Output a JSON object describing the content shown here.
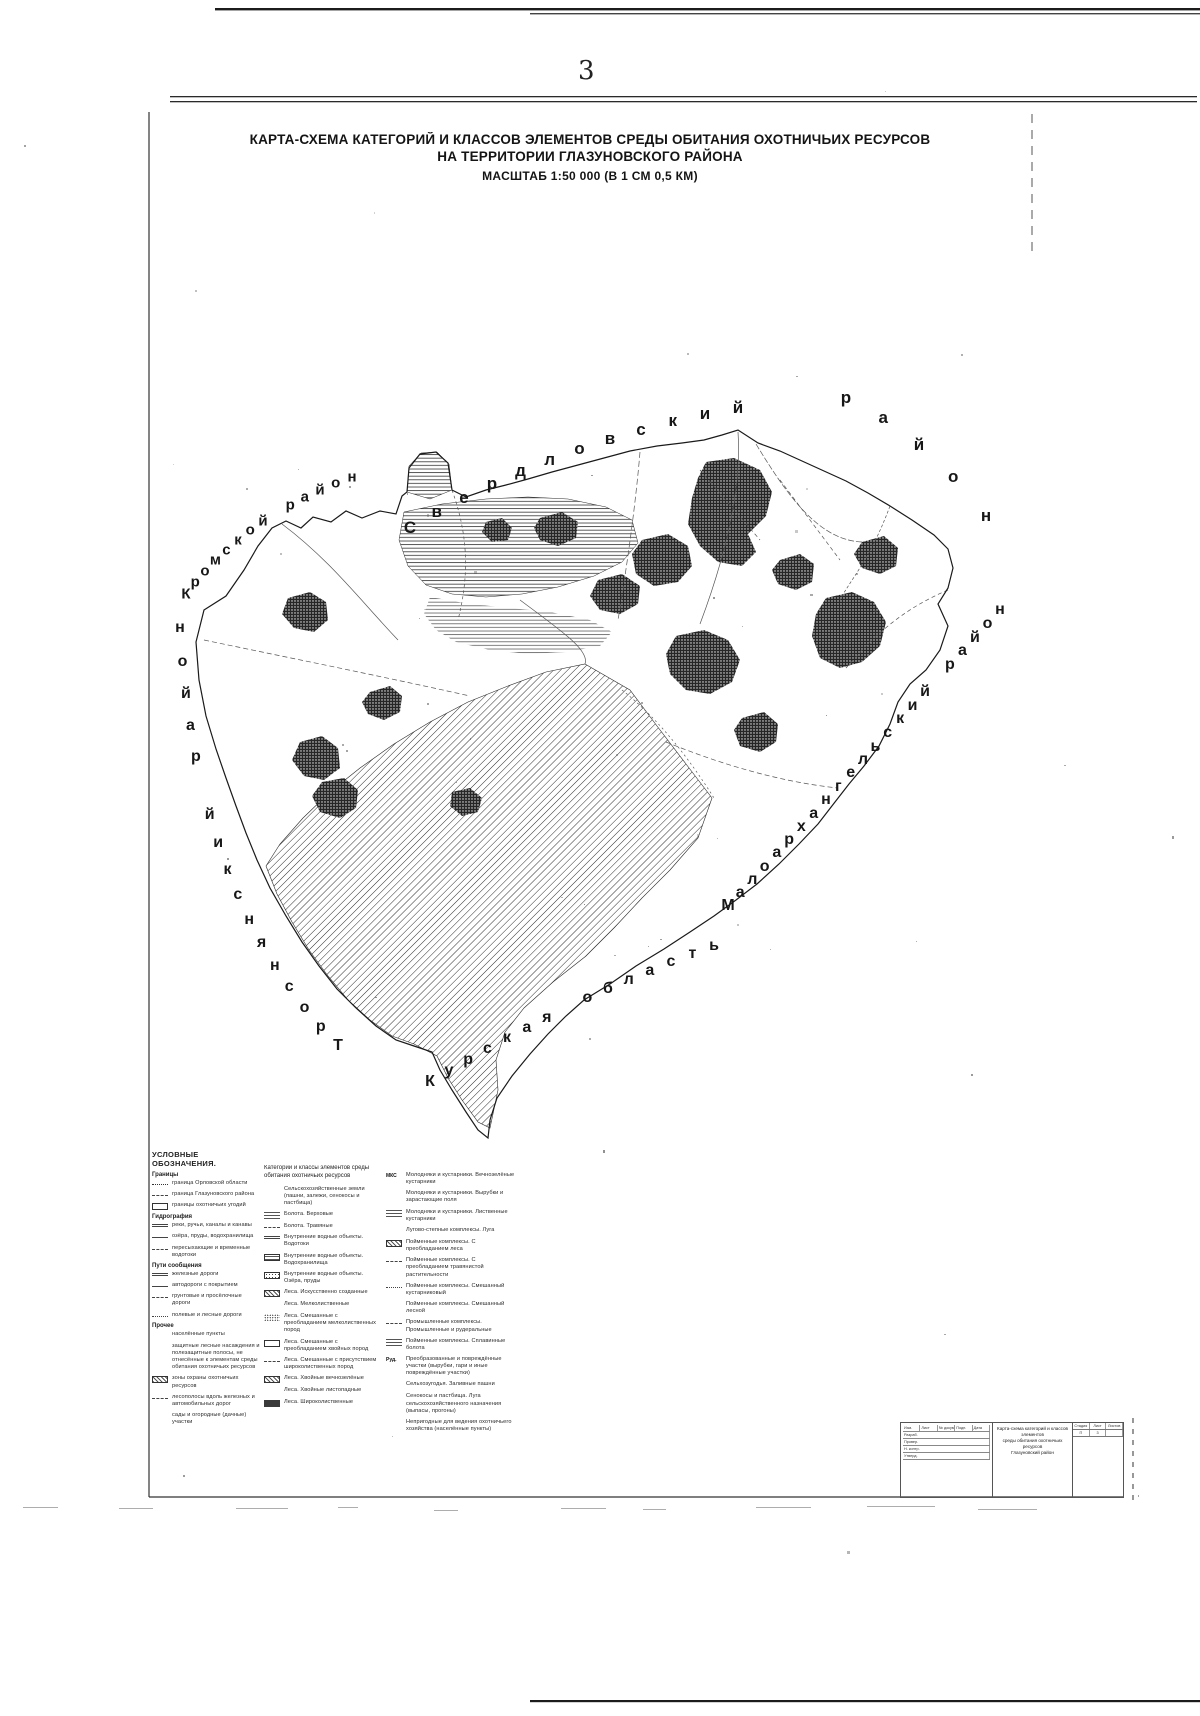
{
  "page": {
    "number": "3"
  },
  "title": {
    "line1": "КАРТА-СХЕМА КАТЕГОРИЙ И КЛАССОВ ЭЛЕМЕНТОВ СРЕДЫ ОБИТАНИЯ ОХОТНИЧЬИХ РЕСУРСОВ",
    "line2": "НА ТЕРРИТОРИИ ГЛАЗУНОВСКОГО РАЙОНА",
    "line3": "МАСШТАБ 1:50 000 (В 1 СМ 0,5 КМ)"
  },
  "map": {
    "neighbors": {
      "kromskoy": "Кромской район",
      "sverdlovsky": "Свердловский",
      "sverdlovsky_rayon": "район",
      "trosnyansky": "Троснянский район",
      "maloarkhangelsky": "Малоархангельский район",
      "kurskaya": "Курская область"
    }
  },
  "legend": {
    "header": "УСЛОВНЫЕ ОБОЗНАЧЕНИЯ.",
    "col1": [
      {
        "section": "Границы"
      },
      {
        "sym": "dashdot",
        "label": "граница Орловской области"
      },
      {
        "sym": "dash",
        "label": "граница Глазуновского района"
      },
      {
        "sym": "rect",
        "label": "границы охотничьих угодий"
      },
      {
        "section": "Гидрография"
      },
      {
        "sym": "dbl",
        "label": "реки, ручьи, каналы и канавы"
      },
      {
        "sym": "line",
        "label": "озёра, пруды, водохранилища"
      },
      {
        "sym": "dash",
        "label": "пересыхающие и временные водотоки"
      },
      {
        "section": "Пути сообщения"
      },
      {
        "sym": "dbl",
        "label": "железные дороги"
      },
      {
        "sym": "line",
        "label": "автодороги с покрытием"
      },
      {
        "sym": "dash",
        "label": "грунтовые и просёлочные дороги"
      },
      {
        "sym": "dot",
        "label": "полевые и лесные дороги"
      },
      {
        "section": "Прочее"
      },
      {
        "sym": "blank",
        "label": "населённые пункты"
      },
      {
        "sym": "blank",
        "label": "защитные лесные насаждения и полезащитные полосы, не отнесённые к элементам среды обитания охотничьих ресурсов"
      },
      {
        "sym": "hatch",
        "label": "зоны охраны охотничьих ресурсов"
      },
      {
        "sym": "dash",
        "label": "лесополосы вдоль железных и автомобильных дорог"
      },
      {
        "sym": "blank",
        "label": "сады и огородные (дачные) участки"
      }
    ],
    "col2_header": "Категории и классы элементов среды обитания охотничьих ресурсов",
    "col2": [
      {
        "sym": "blank",
        "label": "Сельскохозяйственные земли (пашни, залежи, сенокосы и пастбища)"
      },
      {
        "sym": "hlines2",
        "label": "Болота. Верховые"
      },
      {
        "sym": "dash",
        "label": "Болота. Травяные"
      },
      {
        "sym": "dbl",
        "label": "Внутренние водные объекты. Водотоки"
      },
      {
        "sym": "hlines",
        "label": "Внутренние водные объекты. Водохранилища"
      },
      {
        "sym": "dots",
        "label": "Внутренние водные объекты. Озёра, пруды"
      },
      {
        "sym": "hatch",
        "label": "Леса. Искусственно созданные"
      },
      {
        "sym": "blank",
        "label": "Леса. Мелколиственные"
      },
      {
        "sym": "specks",
        "label": "Леса. Смешанные с преобладанием мелколиственных пород"
      },
      {
        "sym": "rect",
        "label": "Леса. Смешанные с преобладанием хвойных пород"
      },
      {
        "sym": "dash",
        "label": "Леса. Смешанные с присутствием широколиственных пород"
      },
      {
        "sym": "hatch",
        "label": "Леса. Хвойные вечнозелёные"
      },
      {
        "sym": "blank",
        "label": "Леса. Хвойные листопадные"
      },
      {
        "sym": "dark",
        "label": "Леса. Широколиственные"
      }
    ],
    "col3": [
      {
        "sym": "tag",
        "tag": "МКС",
        "label": "Молодняки и кустарники. Вечнозелёные кустарники"
      },
      {
        "sym": "blank",
        "label": "Молодняки и кустарники. Вырубки и зарастающие поля"
      },
      {
        "sym": "hlines2",
        "label": "Молодняки и кустарники. Лиственные кустарники"
      },
      {
        "sym": "blank",
        "label": "Лугово-степные комплексы. Луга"
      },
      {
        "sym": "hatch",
        "label": "Пойменные комплексы. С преобладанием леса"
      },
      {
        "sym": "dash",
        "label": "Пойменные комплексы. С преобладанием травянистой растительности"
      },
      {
        "sym": "dot",
        "label": "Пойменные комплексы. Смешанный кустарниковый"
      },
      {
        "sym": "blank",
        "label": "Пойменные комплексы. Смешанный лесной"
      },
      {
        "sym": "dash",
        "label": "Промышленные комплексы. Промышленные и рудеральные"
      },
      {
        "sym": "hlines2",
        "label": "Пойменные комплексы. Сплавинные болота"
      },
      {
        "sym": "tag",
        "tag": "Руд.",
        "label": "Преобразованные и повреждённые участки (вырубки, гари и иные повреждённые участки)"
      },
      {
        "sym": "blank",
        "label": "Сельхозугодья. Заливные пашни"
      },
      {
        "sym": "blank",
        "label": "Сенокосы и пастбища. Луга сельскохозяйственного назначения (выпасы, прогоны)"
      },
      {
        "sym": "blank",
        "label": "Непригодные для ведения охотничьего хозяйства (населённые пункты)"
      }
    ]
  },
  "stamp": {
    "title_line1": "Карта-схема категорий и классов элементов",
    "title_line2": "среды обитания охотничьих ресурсов",
    "title_line3": "Глазуновский район",
    "left_cols": [
      "Изм.",
      "Лист",
      "№ докум.",
      "Подп.",
      "Дата"
    ],
    "roles": [
      "Разраб.",
      "Провер.",
      "Н. контр.",
      "Утверд."
    ],
    "stage_cols": [
      "Стадия",
      "Лист",
      "Листов"
    ],
    "stage_vals": [
      "П",
      "3",
      ""
    ]
  }
}
